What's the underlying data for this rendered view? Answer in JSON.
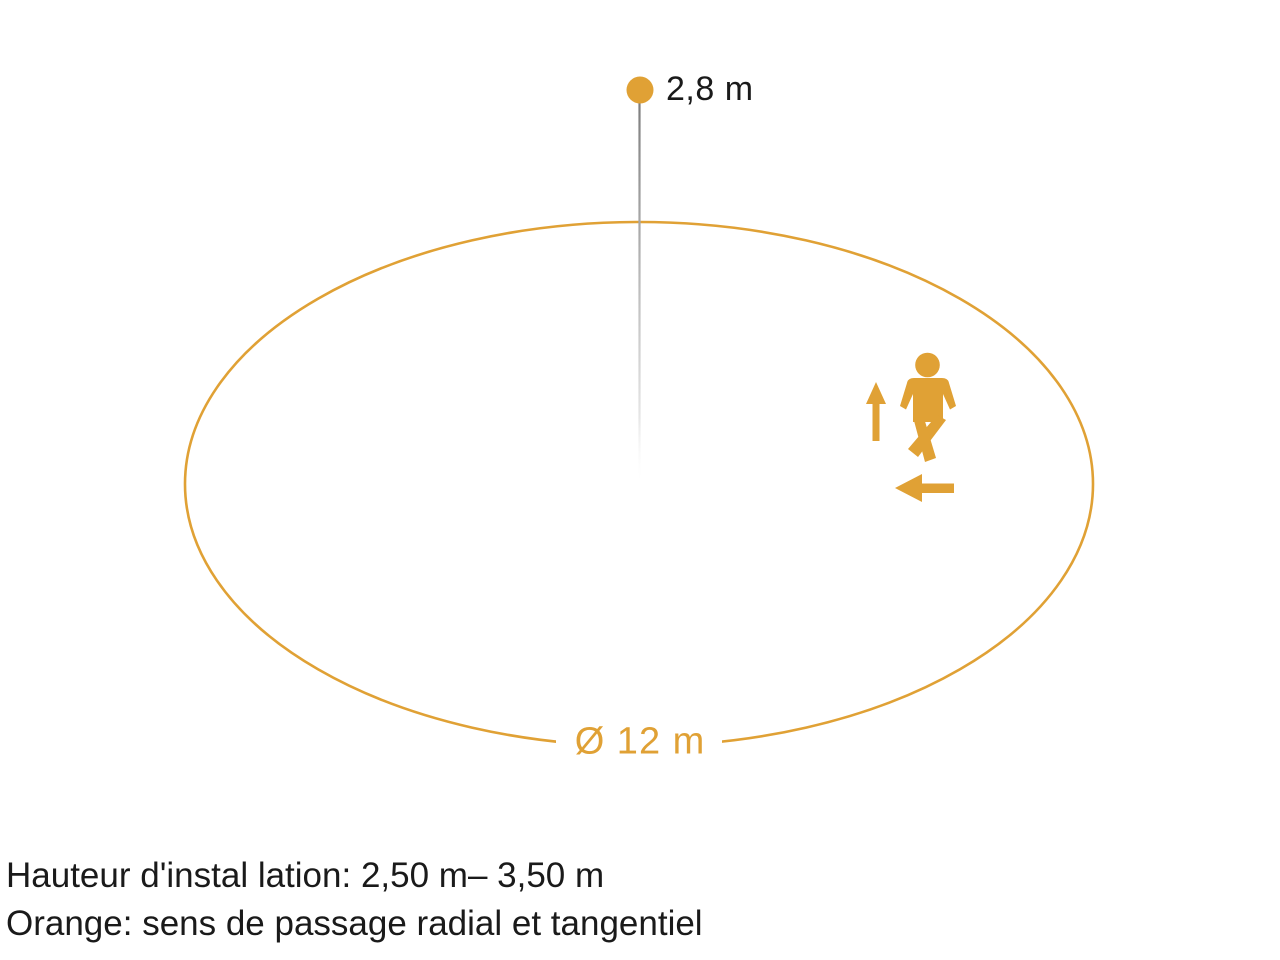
{
  "diagram": {
    "sensor_height_label": "2,8 m",
    "diameter_label": "Ø 12 m",
    "captions": {
      "install_height": "Hauteur d'instal lation: 2,50 m– 3,50 m",
      "legend_orange": "Orange: sens de passage radial et tangentiel"
    },
    "values": {
      "sensor_height": "2,8 m",
      "detection_diameter": "12 m",
      "installation_height_range": "2,50 m – 3,50 m"
    },
    "colors": {
      "accent": "#E0A135",
      "text": "#1A1A1A",
      "pole_gray": "#7E7E7E"
    },
    "icons": {
      "sensor": "sensor-dot-icon",
      "person": "walking-person-icon",
      "radial_direction": "arrow-up-icon",
      "tangential_direction": "arrow-left-icon"
    }
  }
}
